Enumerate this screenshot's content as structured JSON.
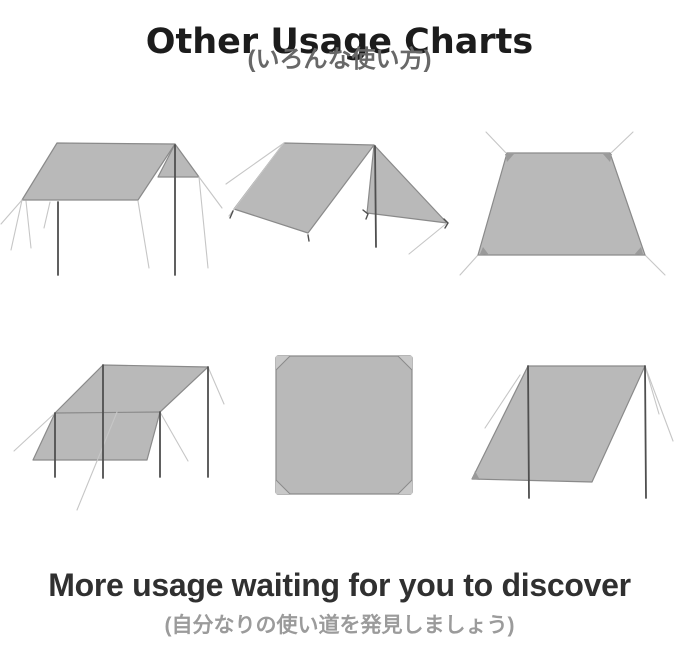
{
  "header": {
    "title": "Other Usage Charts",
    "subtitle_jp": "(いろんな使い方)"
  },
  "footer": {
    "heading": "More usage waiting for you to discover",
    "subtitle_jp": "(自分なりの使い道を発見しましょう)"
  },
  "diagrams": [
    {
      "id": "d1",
      "name": "flat-roof-tarp-with-side-flap"
    },
    {
      "id": "d2",
      "name": "a-frame-tarp-with-center-pole"
    },
    {
      "id": "d3",
      "name": "ground-sheet-staked-flat"
    },
    {
      "id": "d4",
      "name": "lean-to-awning-four-poles"
    },
    {
      "id": "d5",
      "name": "square-tarp-top-view"
    },
    {
      "id": "d6",
      "name": "slanted-windbreak-wall-two-poles"
    }
  ],
  "colors": {
    "background": "#ffffff",
    "tarp_fill": "#b9b9b9",
    "tarp_outline": "#8a8a8a",
    "pole": "#4f4f4f",
    "guy_line": "#c6c6c6",
    "tab": "#9a9a9a",
    "corner_fold": "#c8c8c8",
    "title_text": "#1c1c1c",
    "subtitle_text": "#686868",
    "footer_heading_text": "#303030",
    "footer_subtitle_text": "#9b9b9b"
  }
}
